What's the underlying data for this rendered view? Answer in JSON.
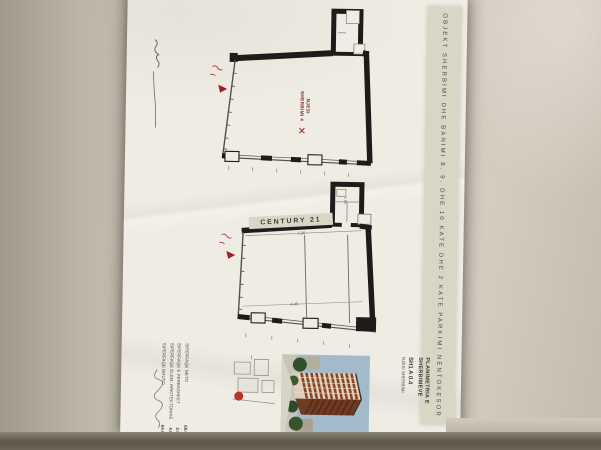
{
  "title_strip": {
    "text": "OBJEKT SHERBIMI DHE BANIMI 8. 9. DHE 10 KATE DHE 2 KATE PARKIMI NENTOKESOR"
  },
  "plan_upper": {
    "unit_label_line1": "NJESI",
    "unit_label_line2": "SHERBIMI 4"
  },
  "plan_lower": {
    "sign_text": "CENTURY 21",
    "dim_top": "7.30",
    "dim_bottom": "4.40",
    "dim_core": "1.80"
  },
  "title_block": {
    "drawing_title_line1": "PLANIMETRIA E",
    "drawing_title_line2": "SHERBIMEVE",
    "unit_code": "SH1 A 0.4",
    "unit_name": "NJESI SHERBIMI"
  },
  "area_table": {
    "rows": [
      {
        "label": "SIPERFAQE NETO",
        "value": "58.02 m²"
      },
      {
        "label": "SIPERFAQE E PERBASHKET",
        "value": "2.06 m²"
      },
      {
        "label": "SIPERFAQE ELEM. ARKITEKTONIKE",
        "value": "4.82 m²"
      },
      {
        "label": "SIPERFAQE BRUTO",
        "value": "64.90 m²"
      }
    ]
  },
  "colors": {
    "wall": "#1d1c1a",
    "red_marker": "#9c2328",
    "strip_bg": "#d9d6c6",
    "page": "#efece4",
    "desk": "#c2bcae",
    "sky": "#a2bac9",
    "facade_band": "#8a4526",
    "tree": "#33502c"
  }
}
